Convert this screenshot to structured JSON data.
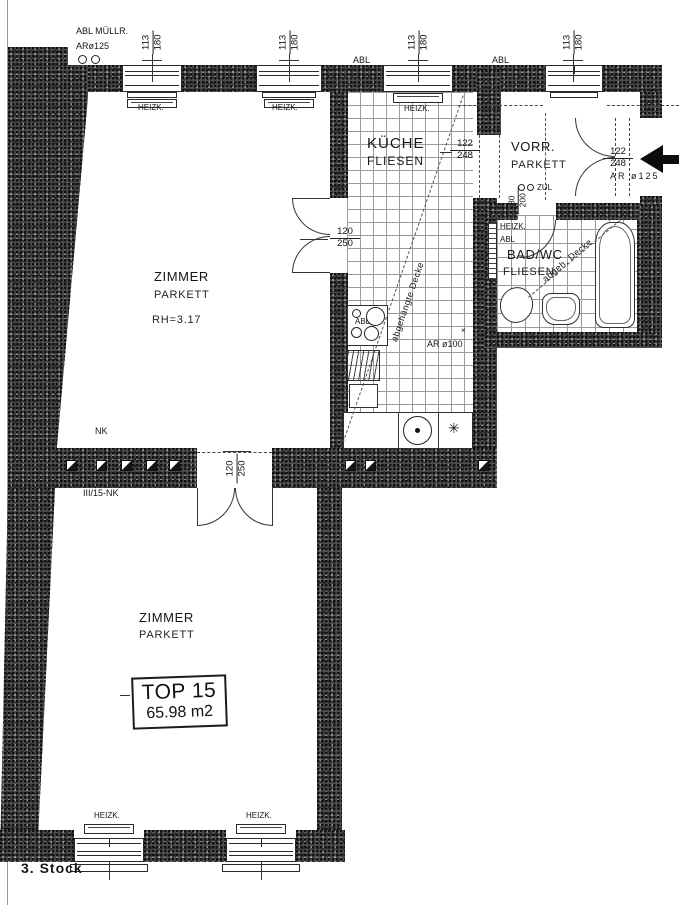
{
  "drawing": {
    "floor_label": "3. Stock",
    "unit_box": {
      "unit": "TOP 15",
      "area": "65.98 m2"
    },
    "top_left": {
      "line1": "ABL MÜLLR.",
      "line2": "ARø125"
    },
    "abl": "ABL",
    "heizk": "HEIZK.",
    "window_dim": {
      "w": "113",
      "h": "180"
    },
    "rooms": {
      "zimmer_upper": {
        "name": "ZIMMER",
        "floor": "PARKETT",
        "height": "RH=3.17"
      },
      "zimmer_lower": {
        "name": "ZIMMER",
        "floor": "PARKETT"
      },
      "kueche": {
        "name": "KÜCHE",
        "floor": "FLIESEN"
      },
      "vorraum": {
        "name": "VORR.",
        "floor": "PARKETT"
      },
      "bad": {
        "name": "BAD/WC",
        "floor": "FLIESEN"
      }
    },
    "doors": {
      "d120": {
        "w": "120",
        "h": "250"
      },
      "d122": {
        "w": "122",
        "h": "248"
      },
      "d80": {
        "w": "80",
        "h": "200"
      }
    },
    "annotations": {
      "nk": "NK",
      "nk_line": "III/15-NK",
      "zul": "ZUL",
      "ar100": "AR ø100",
      "ar125": "AR ø125",
      "ceiling_full": "abgehängte Decke",
      "ceiling_short": "abgeh. Decke",
      "star": "✳",
      "cross": "×"
    }
  }
}
